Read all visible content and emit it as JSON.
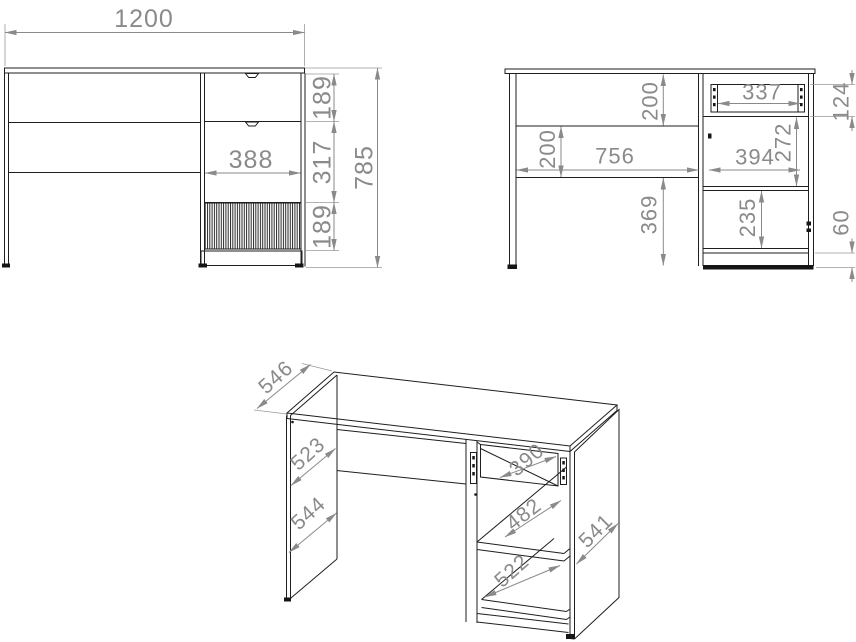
{
  "title": "Desk technical drawing with dimensions (mm)",
  "views": {
    "front": {
      "width": "1200",
      "top_drawer_height": "189",
      "middle_drawer_height": "317",
      "bottom_drawer_height": "189",
      "drawer_front_width": "388",
      "overall_height": "785"
    },
    "section": {
      "apron_height": "200",
      "back_rail_height": "200",
      "knee_space_width": "756",
      "under_rail_height": "369",
      "drawer_inner_width": "337",
      "drawer_box_height": "124",
      "open_compartment_height": "272",
      "cabinet_width": "394",
      "door_compartment_height": "235",
      "plinth_height": "60"
    },
    "perspective": {
      "top_depth": "546",
      "side_panel_upper_depth": "523",
      "side_panel_lower_depth": "544",
      "drawer_depth": "390",
      "middle_shelf_depth": "482",
      "bottom_shelf_depth": "522",
      "right_panel_depth": "541"
    }
  },
  "colors": {
    "outline": "#1e1e1e",
    "dimension": "#8a8a8a",
    "background": "#ffffff"
  }
}
